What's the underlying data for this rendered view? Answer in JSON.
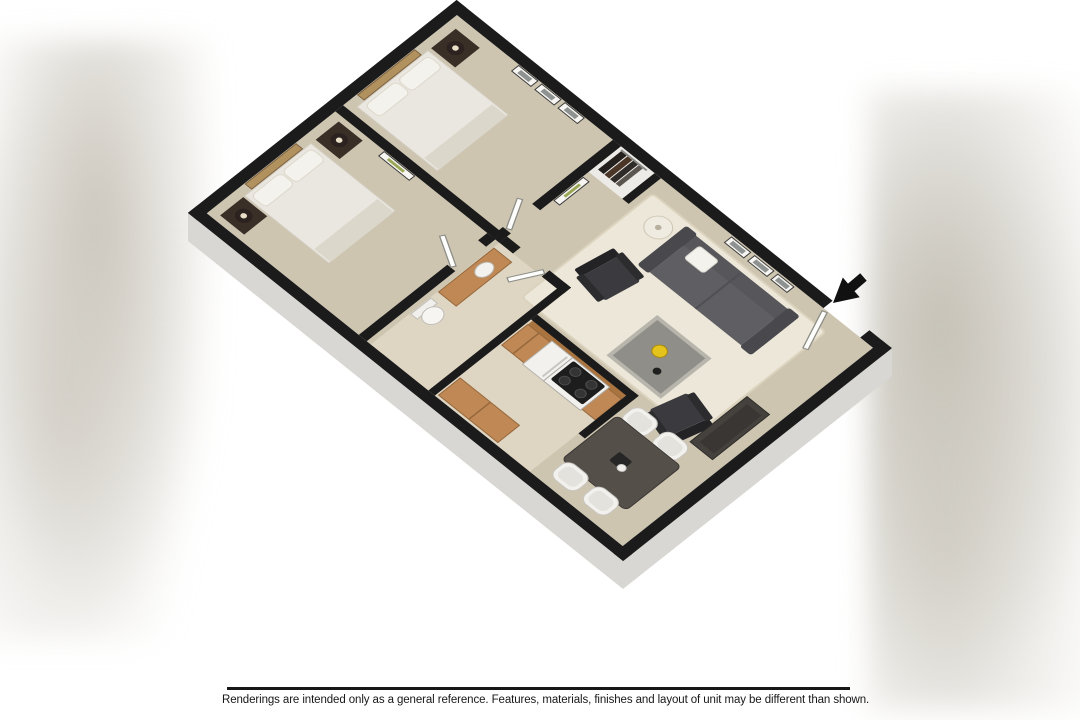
{
  "disclaimer": {
    "text": "Renderings are intended only as a general reference. Features, materials, finishes and layout of unit may be different than shown."
  },
  "icons": {
    "entry_arrow": "arrow-down-left-pointing-to-entry-door"
  },
  "colors": {
    "wall": "#1b1b1b",
    "carpet": "#cec5b1",
    "tile": "#ded5c2",
    "closet_floor": "#ecebe7",
    "rug": "#ece7d8",
    "rug_border": "#dbd3bd",
    "wood": "#bf8854",
    "wood_dark": "#a9743f",
    "wood_line": "#96683c",
    "sofa_body": "#56565b",
    "sofa_seat": "#5e5e63",
    "sofa_arm": "#48484d",
    "chair_black": "#3b3b3f",
    "chair_back": "#232326",
    "coffee_top": "#8f8e88",
    "coffee_frame": "#b8b5ad",
    "accent_yellow": "#e5c31d",
    "dining_table": "#544f49",
    "dining_chair": "#f2f1ed",
    "bed_duvet": "#eae7e0",
    "bed_foot": "#dcd7cb",
    "pillow": "#f4f2ec",
    "nightstand": "#3a2f27",
    "lamp_dark": "#2c2320",
    "art_tan": "#b1925f",
    "frame_white": "#f6f5f1",
    "frame_art": "#8e9290",
    "frame_green": "#9aa855",
    "appliance": "#f2f1ee",
    "cooktop": "#1d1d1d",
    "exterior_face": "#d8d7d3",
    "door_leaf": "#fdfdfb",
    "caption": "#171717"
  }
}
